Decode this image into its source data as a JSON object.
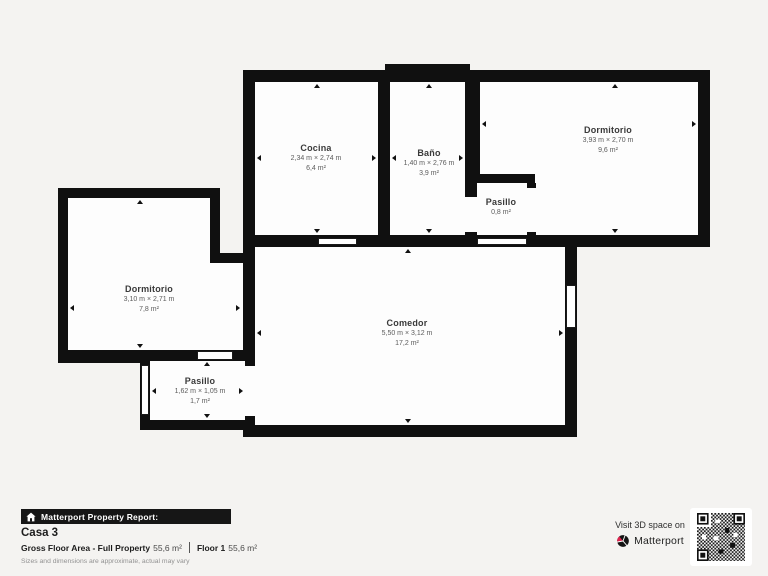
{
  "background": "#f4f3f1",
  "plan": {
    "wall_color": "#101010",
    "room_fill": "#fdfdfd",
    "rooms": [
      {
        "id": "cocina",
        "name": "Cocina",
        "dimensions": "2,34 m × 2,74 m",
        "area": "6,4 m²"
      },
      {
        "id": "bano",
        "name": "Baño",
        "dimensions": "1,40 m × 2,76 m",
        "area": "3,9 m²"
      },
      {
        "id": "dormitorio-right",
        "name": "Dormitorio",
        "dimensions": "3,93 m × 2,70 m",
        "area": "9,6 m²"
      },
      {
        "id": "pasillo-small",
        "name": "Pasillo",
        "dimensions": "",
        "area": "0,8 m²"
      },
      {
        "id": "dormitorio-left",
        "name": "Dormitorio",
        "dimensions": "3,10 m × 2,71 m",
        "area": "7,8 m²"
      },
      {
        "id": "comedor",
        "name": "Comedor",
        "dimensions": "5,50 m × 3,12 m",
        "area": "17,2 m²"
      },
      {
        "id": "pasillo-bottom",
        "name": "Pasillo",
        "dimensions": "1,62 m × 1,05 m",
        "area": "1,7 m²"
      }
    ]
  },
  "footer": {
    "report_label": "Matterport Property Report:",
    "property_name": "Casa 3",
    "gfa_label": "Gross Floor Area - Full Property",
    "gfa_value": "55,6 m²",
    "floor_label": "Floor 1",
    "floor_value": "55,6 m²",
    "disclaimer": "Sizes and dimensions are approximate, actual may vary",
    "visit_label": "Visit 3D space on",
    "brand": "Matterport",
    "brand_red": "#e0234e"
  }
}
